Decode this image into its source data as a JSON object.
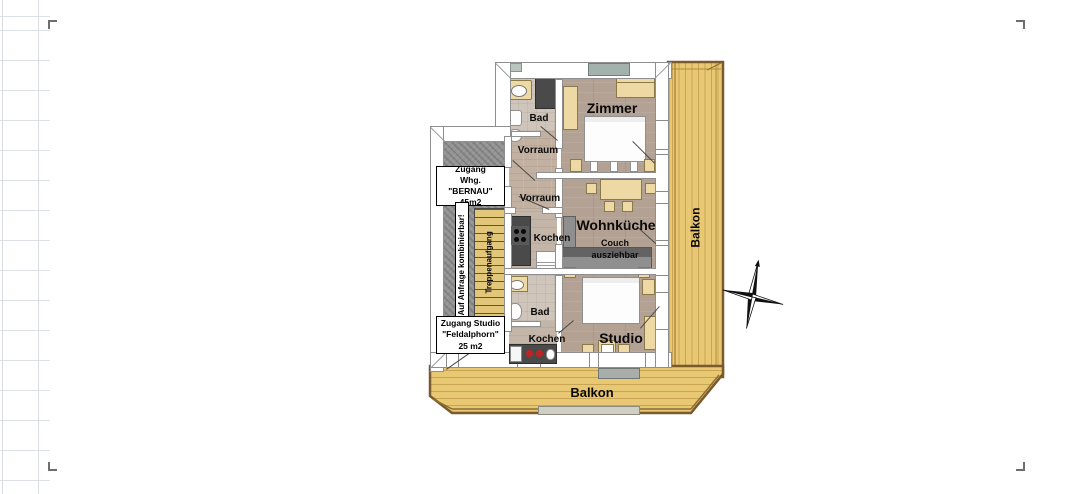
{
  "plan": {
    "labels": {
      "bad_top": "Bad",
      "vorraum_top": "Vorraum",
      "vorraum_mid": "Vorraum",
      "zimmer": "Zimmer",
      "kochen_top": "Kochen",
      "wohnkueche": "Wohnküche",
      "couch": [
        "Couch",
        "ausziehbar"
      ],
      "bad_bottom": "Bad",
      "kochen_bottom": "Kochen",
      "studio": "Studio",
      "balkon_right": "Balkon",
      "balkon_bottom": "Balkon"
    },
    "annex": {
      "bernau": [
        "Zugang",
        "Whg. \"BERNAU\"",
        "45m2"
      ],
      "kombinierbar": "Auf Anfrage kombinierbar!",
      "treppenaufgang": "Treppenaufgang",
      "feldalphorn": [
        "Zugang Studio",
        "\"Feldalphorn\"",
        "25 m2"
      ]
    },
    "colors": {
      "balcony_wood": "#e9c873",
      "balcony_line": "#c9a455",
      "balcony_border": "#7a5a2c",
      "interior_wood": "#b3a294",
      "stair_wood": "#e2c67a",
      "stairwell_gray": "#949494",
      "counter_dark": "#4a4a4a",
      "furniture_tan": "#eed9a4",
      "window_block": "#a3b2ac",
      "label_text": "#0a0a0a"
    }
  }
}
